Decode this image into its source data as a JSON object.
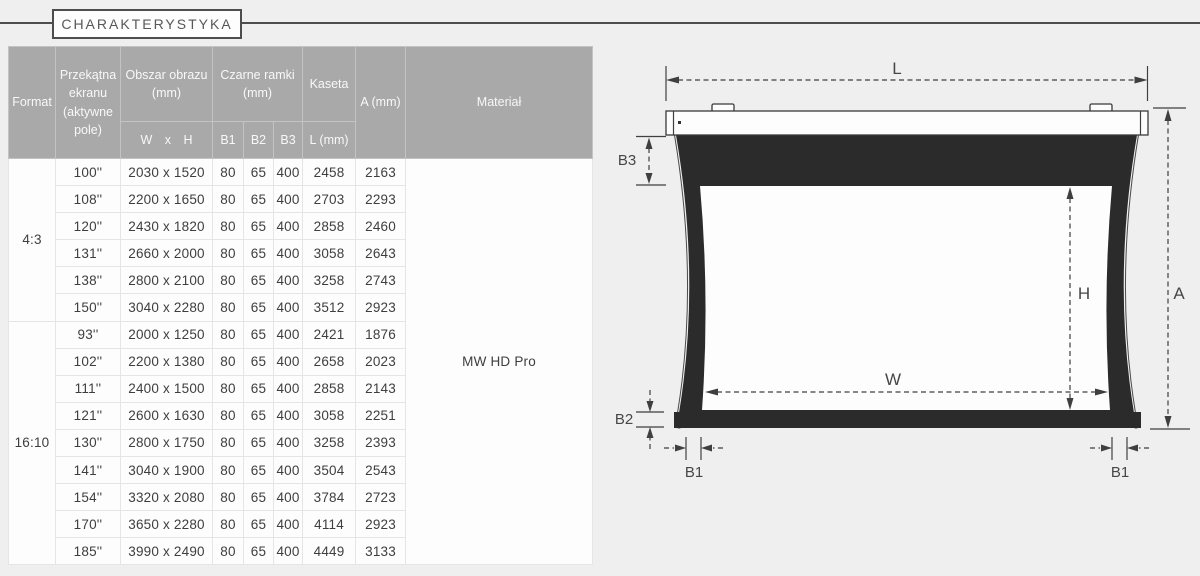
{
  "page": {
    "title": "CHARAKTERYSTYKA"
  },
  "table": {
    "headers": {
      "format": "Format",
      "diagonal": "Przekątna ekranu (aktywne pole)",
      "image_area": "Obszar obrazu (mm)",
      "image_area_sub": "W x H",
      "black_frames": "Czarne ramki (mm)",
      "b1": "B1",
      "b2": "B2",
      "b3": "B3",
      "cassette": "Kaseta",
      "cassette_sub": "L (mm)",
      "a": "A (mm)",
      "material": "Materiał"
    },
    "material_value": "MW HD Pro",
    "groups": [
      {
        "format": "4:3",
        "rows": [
          {
            "diagonal": "100''",
            "wxh": "2030 x 1520",
            "b1": "80",
            "b2": "65",
            "b3": "400",
            "l": "2458",
            "a": "2163"
          },
          {
            "diagonal": "108''",
            "wxh": "2200 x 1650",
            "b1": "80",
            "b2": "65",
            "b3": "400",
            "l": "2703",
            "a": "2293"
          },
          {
            "diagonal": "120''",
            "wxh": "2430 x 1820",
            "b1": "80",
            "b2": "65",
            "b3": "400",
            "l": "2858",
            "a": "2460"
          },
          {
            "diagonal": "131''",
            "wxh": "2660 x 2000",
            "b1": "80",
            "b2": "65",
            "b3": "400",
            "l": "3058",
            "a": "2643"
          },
          {
            "diagonal": "138''",
            "wxh": "2800 x 2100",
            "b1": "80",
            "b2": "65",
            "b3": "400",
            "l": "3258",
            "a": "2743"
          },
          {
            "diagonal": "150''",
            "wxh": "3040 x 2280",
            "b1": "80",
            "b2": "65",
            "b3": "400",
            "l": "3512",
            "a": "2923"
          }
        ]
      },
      {
        "format": "16:10",
        "rows": [
          {
            "diagonal": "93''",
            "wxh": "2000 x 1250",
            "b1": "80",
            "b2": "65",
            "b3": "400",
            "l": "2421",
            "a": "1876"
          },
          {
            "diagonal": "102''",
            "wxh": "2200 x 1380",
            "b1": "80",
            "b2": "65",
            "b3": "400",
            "l": "2658",
            "a": "2023"
          },
          {
            "diagonal": "111''",
            "wxh": "2400 x 1500",
            "b1": "80",
            "b2": "65",
            "b3": "400",
            "l": "2858",
            "a": "2143"
          },
          {
            "diagonal": "121''",
            "wxh": "2600 x 1630",
            "b1": "80",
            "b2": "65",
            "b3": "400",
            "l": "3058",
            "a": "2251"
          },
          {
            "diagonal": "130''",
            "wxh": "2800 x 1750",
            "b1": "80",
            "b2": "65",
            "b3": "400",
            "l": "3258",
            "a": "2393"
          },
          {
            "diagonal": "141''",
            "wxh": "3040 x 1900",
            "b1": "80",
            "b2": "65",
            "b3": "400",
            "l": "3504",
            "a": "2543"
          },
          {
            "diagonal": "154''",
            "wxh": "3320 x 2080",
            "b1": "80",
            "b2": "65",
            "b3": "400",
            "l": "3784",
            "a": "2723"
          },
          {
            "diagonal": "170''",
            "wxh": "3650 x 2280",
            "b1": "80",
            "b2": "65",
            "b3": "400",
            "l": "4114",
            "a": "2923"
          },
          {
            "diagonal": "185''",
            "wxh": "3990 x 2490",
            "b1": "80",
            "b2": "65",
            "b3": "400",
            "l": "4449",
            "a": "3133"
          }
        ]
      }
    ]
  },
  "diagram": {
    "labels": {
      "l": "L",
      "b3": "B3",
      "h": "H",
      "a": "A",
      "w": "W",
      "b2": "B2",
      "b1": "B1"
    }
  },
  "colors": {
    "background": "#efefef",
    "header_bg": "#a9a9a9",
    "screen_dark": "#2b2b2b",
    "line_dark": "#4d4d4d"
  }
}
